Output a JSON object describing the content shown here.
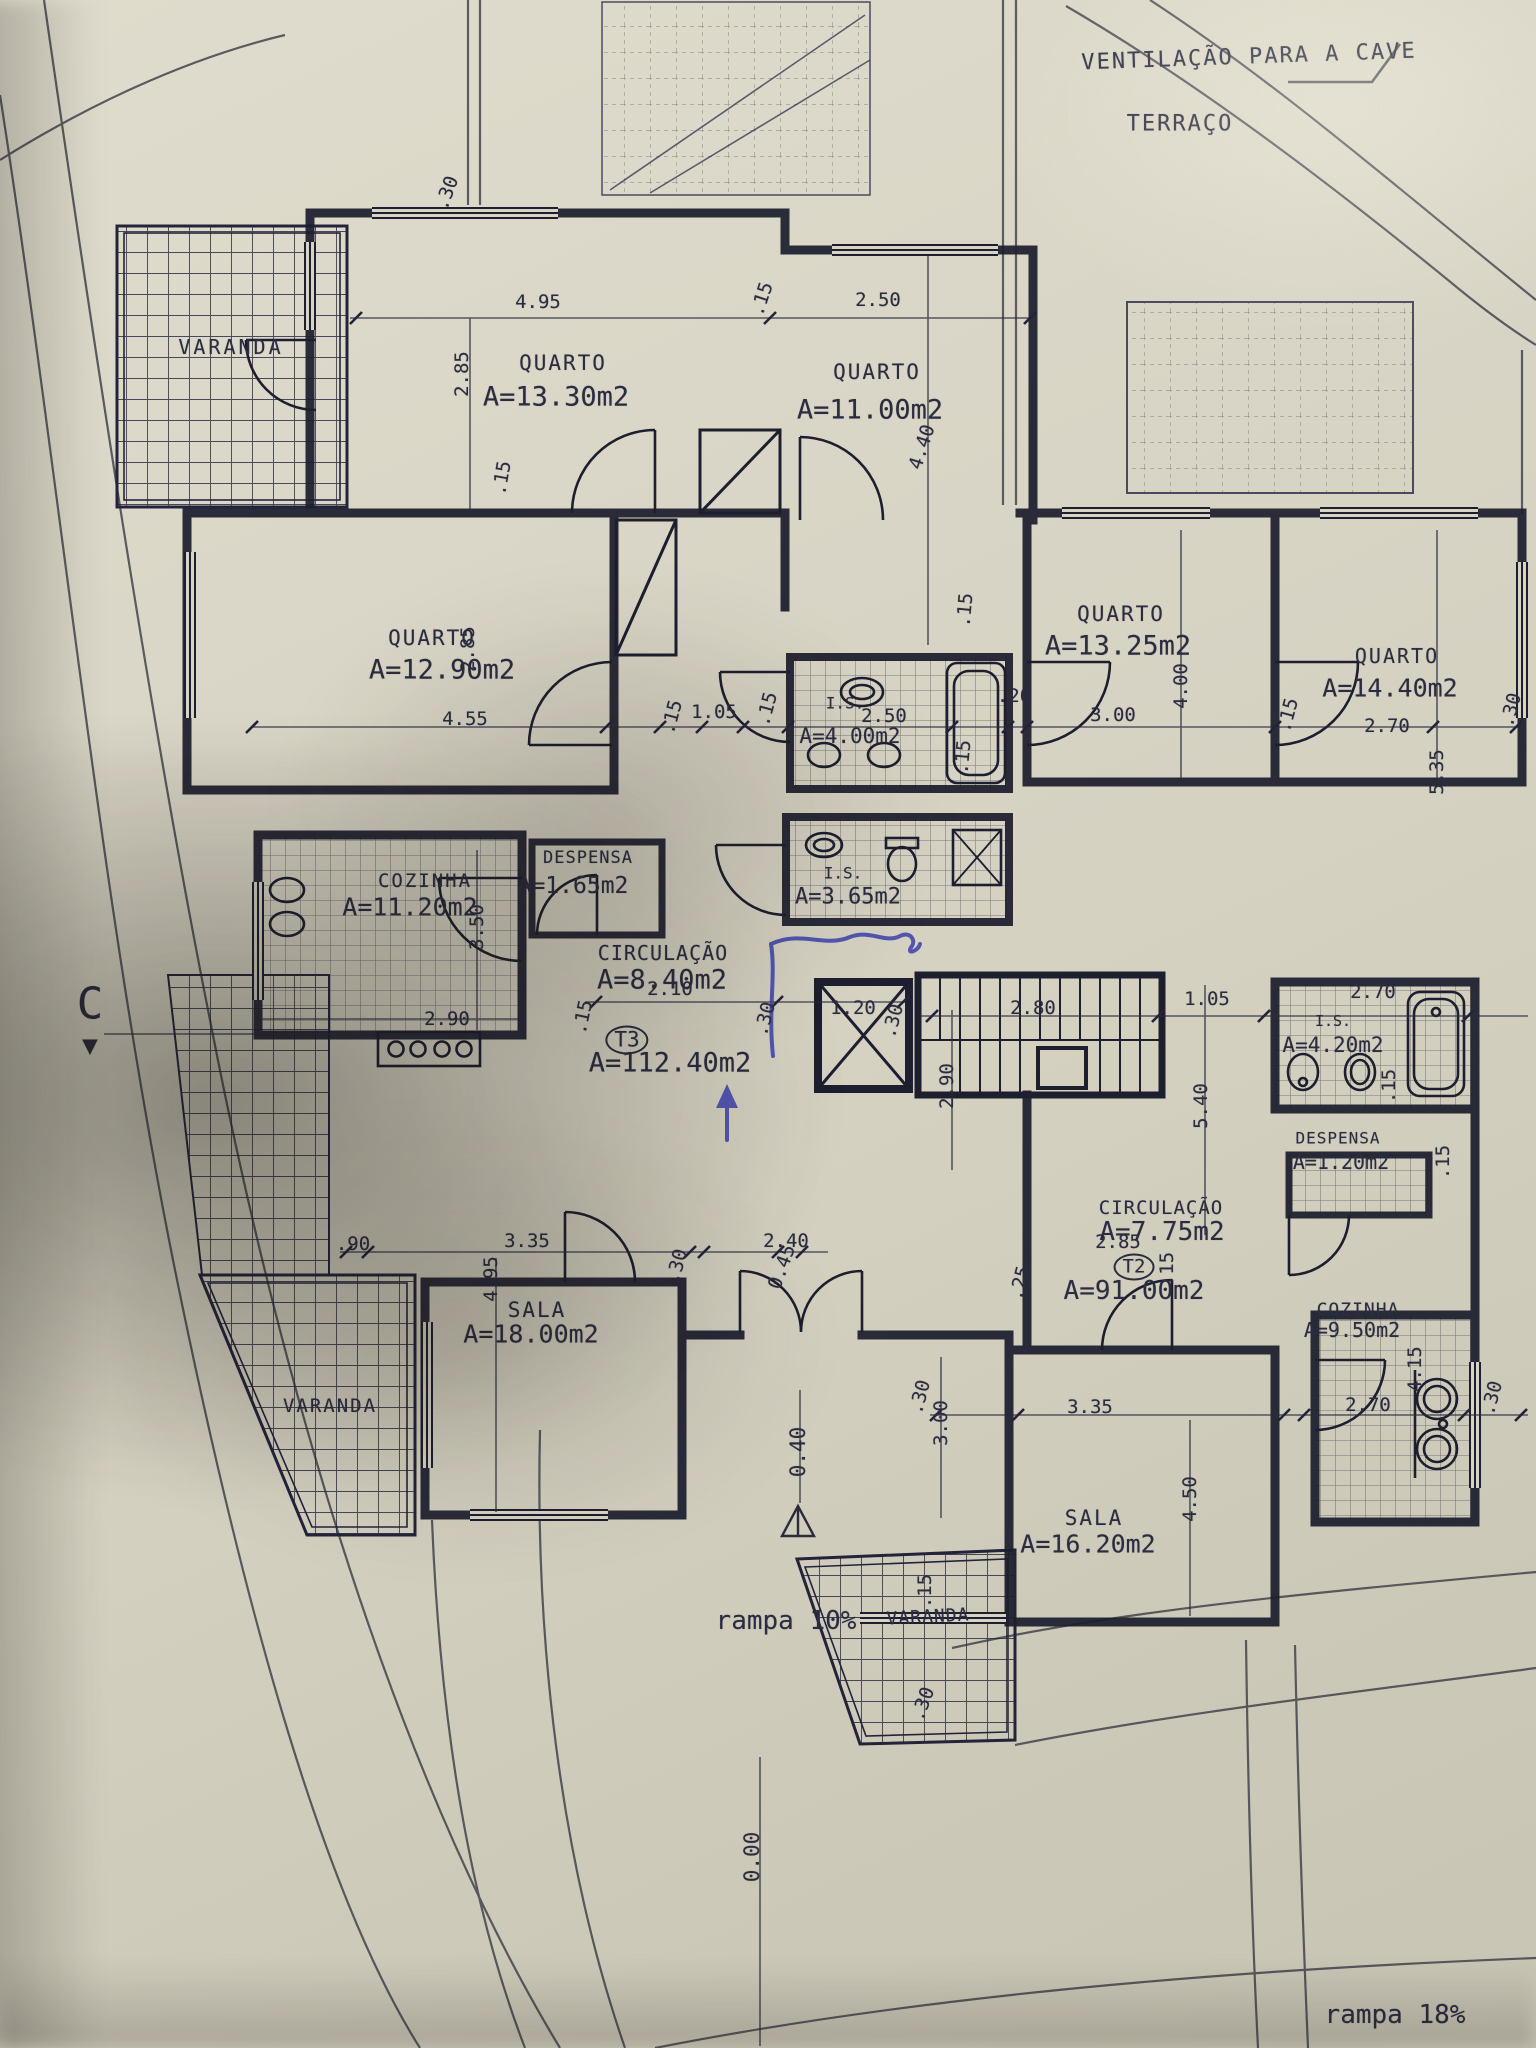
{
  "document": {
    "kind": "architectural floor plan photograph",
    "ink_color": "#262839",
    "paper_color": "#d8d4c5",
    "pen_color": "#3c40ae"
  },
  "annotations": {
    "ventilation_note": "VENTILAÇÃO PARA A CAVE",
    "terrace": "TERRAÇO",
    "section_marker": "C",
    "section_arrow": "▼",
    "ramp_left": "rampa 10%",
    "ramp_right": "rampa 18%",
    "level_entrance": "0.40",
    "level_ground": "0.00"
  },
  "apartments": {
    "t3": {
      "tag": "T3",
      "total_area": "A=112.40m2"
    },
    "t2": {
      "tag": "T2",
      "total_area": "A=91.00m2"
    }
  },
  "labels": [
    {
      "g": "t3",
      "t": "VARANDA",
      "x": 231,
      "y": 347,
      "fs": 20,
      "ls": 3
    },
    {
      "g": "t3",
      "t": "QUARTO",
      "x": 563,
      "y": 363,
      "fs": 21,
      "ls": 2
    },
    {
      "g": "t3",
      "t": "A=13.30m2",
      "x": 556,
      "y": 397,
      "fs": 27
    },
    {
      "g": "t3",
      "t": "QUARTO",
      "x": 877,
      "y": 372,
      "fs": 21,
      "ls": 2
    },
    {
      "g": "t3",
      "t": "A=11.00m2",
      "x": 870,
      "y": 410,
      "fs": 27
    },
    {
      "g": "t3",
      "t": "QUARTO",
      "x": 432,
      "y": 638,
      "fs": 21,
      "ls": 2
    },
    {
      "g": "t3",
      "t": "A=12.90m2",
      "x": 442,
      "y": 670,
      "fs": 27
    },
    {
      "g": "t3",
      "t": "COZINHA",
      "x": 425,
      "y": 881,
      "fs": 19,
      "ls": 2
    },
    {
      "g": "t3",
      "t": "A=11.20m2",
      "x": 410,
      "y": 907,
      "fs": 25
    },
    {
      "g": "t3",
      "t": "DESPENSA",
      "x": 588,
      "y": 858,
      "fs": 17,
      "ls": 1
    },
    {
      "g": "t3",
      "t": "A=1.65m2",
      "x": 573,
      "y": 886,
      "fs": 23
    },
    {
      "g": "t3",
      "t": "I.S.",
      "x": 845,
      "y": 703,
      "fs": 16
    },
    {
      "g": "t3",
      "t": "A=4.00m2",
      "x": 850,
      "y": 736,
      "fs": 21
    },
    {
      "g": "t3",
      "t": "I.S.",
      "x": 843,
      "y": 873,
      "fs": 16
    },
    {
      "g": "t3",
      "t": "A=3.65m2",
      "x": 848,
      "y": 897,
      "fs": 22
    },
    {
      "g": "t3",
      "t": "CIRCULAÇÃO",
      "x": 663,
      "y": 953,
      "fs": 20,
      "ls": 1
    },
    {
      "g": "t3",
      "t": "A=8.40m2",
      "x": 662,
      "y": 980,
      "fs": 27
    },
    {
      "g": "t3",
      "t": "T3",
      "x": 627,
      "y": 1040,
      "fs": 21,
      "circ": true
    },
    {
      "g": "t3",
      "t": "A=112.40m2",
      "x": 670,
      "y": 1063,
      "fs": 27
    },
    {
      "g": "t3",
      "t": "SALA",
      "x": 537,
      "y": 1310,
      "fs": 21,
      "ls": 2
    },
    {
      "g": "t3",
      "t": "A=18.00m2",
      "x": 531,
      "y": 1334,
      "fs": 25
    },
    {
      "g": "t3",
      "t": "VARANDA",
      "x": 330,
      "y": 1406,
      "fs": 19,
      "ls": 2
    },
    {
      "g": "t2",
      "t": "QUARTO",
      "x": 1121,
      "y": 614,
      "fs": 21,
      "ls": 2
    },
    {
      "g": "t2",
      "t": "A=13.25m2",
      "x": 1118,
      "y": 646,
      "fs": 27
    },
    {
      "g": "t2",
      "t": "QUARTO",
      "x": 1397,
      "y": 656,
      "fs": 20,
      "ls": 2
    },
    {
      "g": "t2",
      "t": "A=14.40m2",
      "x": 1390,
      "y": 688,
      "fs": 25
    },
    {
      "g": "t2",
      "t": "I.S.",
      "x": 1333,
      "y": 1021,
      "fs": 15
    },
    {
      "g": "t2",
      "t": "A=4.20m2",
      "x": 1333,
      "y": 1045,
      "fs": 21
    },
    {
      "g": "t2",
      "t": "DESPENSA",
      "x": 1338,
      "y": 1138,
      "fs": 16,
      "ls": 1
    },
    {
      "g": "t2",
      "t": "A=1.20m2",
      "x": 1341,
      "y": 1162,
      "fs": 20
    },
    {
      "g": "t2",
      "t": "CIRCULAÇÃO",
      "x": 1161,
      "y": 1208,
      "fs": 19,
      "ls": 1
    },
    {
      "g": "t2",
      "t": "A=7.75m2",
      "x": 1162,
      "y": 1232,
      "fs": 26
    },
    {
      "g": "t2",
      "t": "T2",
      "x": 1134,
      "y": 1267,
      "fs": 19,
      "circ": true
    },
    {
      "g": "t2",
      "t": "A=91.00m2",
      "x": 1134,
      "y": 1291,
      "fs": 26
    },
    {
      "g": "t2",
      "t": "COZINHA",
      "x": 1358,
      "y": 1310,
      "fs": 18,
      "ls": 1
    },
    {
      "g": "t2",
      "t": "A=9.50m2",
      "x": 1352,
      "y": 1330,
      "fs": 20
    },
    {
      "g": "t2",
      "t": "SALA",
      "x": 1094,
      "y": 1518,
      "fs": 21,
      "ls": 2
    },
    {
      "g": "t2",
      "t": "A=16.20m2",
      "x": 1088,
      "y": 1544,
      "fs": 25
    },
    {
      "g": "t2",
      "t": "VARANDA",
      "x": 928,
      "y": 1617,
      "fs": 18,
      "ls": 1,
      "r": -3
    }
  ],
  "dimensions": [
    [
      ".30",
      447,
      193,
      -70
    ],
    [
      "4.95",
      538,
      302,
      0
    ],
    [
      "2.85",
      462,
      374,
      -90
    ],
    [
      ".15",
      762,
      299,
      -72
    ],
    [
      "2.50",
      878,
      300,
      0
    ],
    [
      "4.40",
      922,
      447,
      -72
    ],
    [
      ".15",
      502,
      478,
      -80
    ],
    [
      "2.85",
      468,
      649,
      -90
    ],
    [
      "4.55",
      465,
      719,
      0
    ],
    [
      ".15",
      672,
      717,
      -75
    ],
    [
      "1.05",
      714,
      712,
      0
    ],
    [
      ".15",
      767,
      709,
      -75
    ],
    [
      "2.50",
      884,
      716,
      0
    ],
    [
      ".20",
      1014,
      696,
      0
    ],
    [
      "3.00",
      1113,
      715,
      0
    ],
    [
      "4.00",
      1181,
      686,
      -90
    ],
    [
      ".15",
      965,
      610,
      -85
    ],
    [
      ".15",
      963,
      757,
      -85
    ],
    [
      "2.70",
      1387,
      726,
      0
    ],
    [
      "5.35",
      1437,
      772,
      -90
    ],
    [
      ".15",
      1288,
      715,
      -75
    ],
    [
      ".30",
      1511,
      710,
      -75
    ],
    [
      "2.90",
      447,
      1019,
      0
    ],
    [
      "3.50",
      477,
      927,
      -90
    ],
    [
      ".15",
      583,
      1017,
      -78
    ],
    [
      "2.10",
      670,
      989,
      0
    ],
    [
      "1.20",
      853,
      1008,
      0
    ],
    [
      ".30",
      765,
      1019,
      -75
    ],
    [
      ".30",
      893,
      1021,
      -75
    ],
    [
      "2.80",
      1033,
      1008,
      0
    ],
    [
      "1.05",
      1207,
      999,
      0
    ],
    [
      "2.70",
      1373,
      992,
      0
    ],
    [
      "2.90",
      947,
      1086,
      -90
    ],
    [
      "5.40",
      1201,
      1106,
      -90
    ],
    [
      ".15",
      1389,
      1086,
      -90
    ],
    [
      ".15",
      1443,
      1162,
      -90
    ],
    [
      "2.85",
      1118,
      1242,
      0
    ],
    [
      ".25",
      1020,
      1283,
      -75
    ],
    [
      ".15",
      1167,
      1269,
      -90
    ],
    [
      ".90",
      353,
      1244,
      0
    ],
    [
      "3.35",
      527,
      1241,
      0
    ],
    [
      "4.95",
      491,
      1279,
      -90
    ],
    [
      "2.40",
      786,
      1241,
      0
    ],
    [
      "0.45",
      782,
      1267,
      -70
    ],
    [
      ".30",
      677,
      1266,
      -75
    ],
    [
      "3.35",
      1090,
      1407,
      0
    ],
    [
      "3.00",
      941,
      1423,
      -90
    ],
    [
      ".30",
      920,
      1397,
      -75
    ],
    [
      ".30",
      1492,
      1398,
      -75
    ],
    [
      "2.70",
      1368,
      1405,
      0
    ],
    [
      "4.15",
      1415,
      1369,
      -90
    ],
    [
      "4.50",
      1190,
      1499,
      -90
    ],
    [
      ".15",
      925,
      1591,
      -90
    ],
    [
      ".30",
      923,
      1704,
      -70
    ]
  ]
}
